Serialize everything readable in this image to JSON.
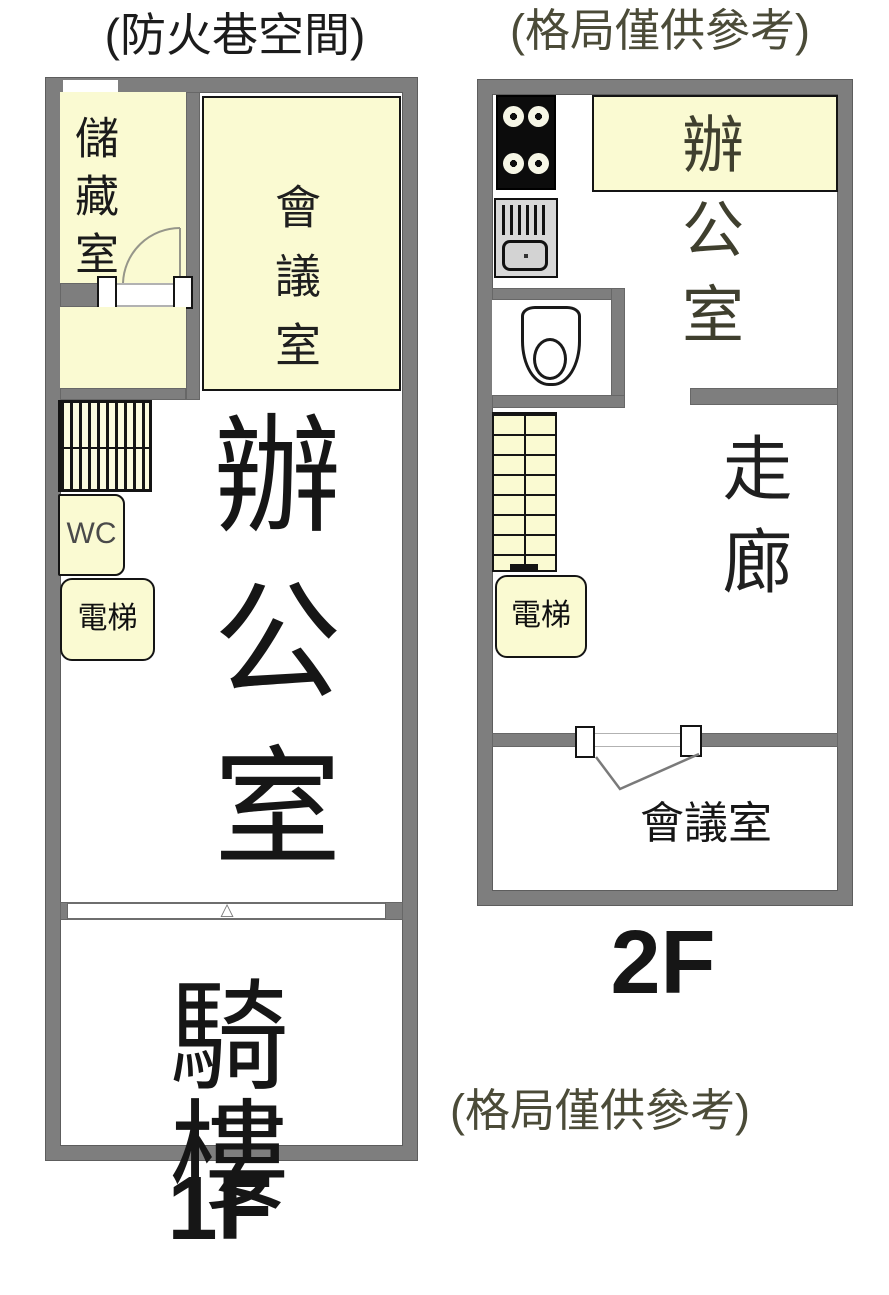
{
  "floor1": {
    "title": "(防火巷空間)",
    "label": "1F",
    "rooms": {
      "storage": "儲藏室",
      "meeting": "會議室",
      "wc": "WC",
      "elevator": "電梯",
      "office": "辦公室",
      "arcade": "騎樓"
    }
  },
  "floor2": {
    "title": "(格局僅供參考)",
    "label": "2F",
    "rooms": {
      "office": "辦公室",
      "corridor": "走廊",
      "elevator": "電梯",
      "meeting": "會議室"
    }
  },
  "notes": {
    "bottom": "(格局僅供參考)"
  },
  "icons": {
    "window_marker": "△"
  },
  "colors": {
    "wall": "#7e7e7e",
    "room_fill": "#fafad2",
    "floor_fill": "#ffffff",
    "stove_black": "#0d0d0d",
    "appliance_gray": "#d8d8d8",
    "text_primary": "#1a1a1a",
    "text_note": "#4b4b38"
  }
}
